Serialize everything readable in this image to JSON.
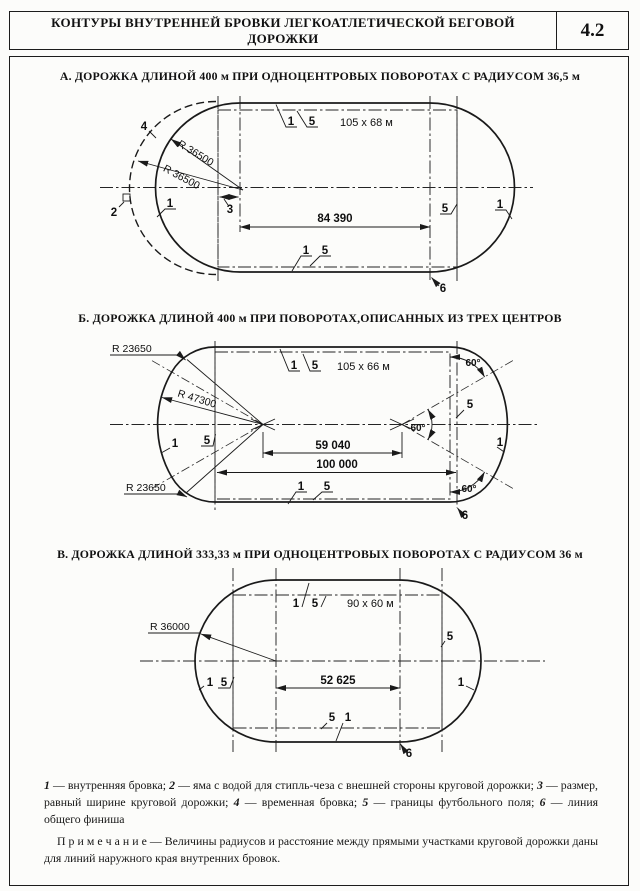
{
  "header": {
    "title": "КОНТУРЫ ВНУТРЕННЕЙ БРОВКИ ЛЕГКОАТЛЕТИЧЕСКОЙ БЕГОВОЙ ДОРОЖКИ",
    "number": "4.2"
  },
  "diagram_a": {
    "title": "А. ДОРОЖКА ДЛИНОЙ 400 м ПРИ ОДНОЦЕНТРОВЫХ ПОВОРОТАХ С РАДИУСОМ 36,5 м",
    "field_size": "105 x 68 м",
    "dim_straight": "84 390",
    "radius_curb": "R 36500",
    "radius_temp": "R 36500",
    "n1": "1",
    "n2": "2",
    "n3": "3",
    "n4": "4",
    "n5": "5",
    "n6": "6"
  },
  "diagram_b": {
    "title": "Б. ДОРОЖКА ДЛИНОЙ 400 м ПРИ ПОВОРОТАХ,ОПИСАННЫХ ИЗ ТРЕХ ЦЕНТРОВ",
    "field_size": "105 x 66 м",
    "dim_centers": "59 040",
    "dim_straight": "100 000",
    "radius_corner_top": "R 23650",
    "radius_corner_bottom": "R 23650",
    "radius_middle": "R 47300",
    "angle": "60°",
    "n1": "1",
    "n5": "5",
    "n6": "6"
  },
  "diagram_v": {
    "title": "В. ДОРОЖКА ДЛИНОЙ 333,33 м ПРИ ОДНОЦЕНТРОВЫХ ПОВОРОТАХ С РАДИУСОМ 36 м",
    "field_size": "90 x 60 м",
    "dim_straight": "52 625",
    "radius": "R 36000",
    "n1": "1",
    "n5": "5",
    "n6": "6"
  },
  "legend": {
    "items": [
      {
        "num": "1",
        "text": "— внутренняя бровка;"
      },
      {
        "num": "2",
        "text": "— яма с водой для стипль-чеза с внешней стороны круговой дорожки;"
      },
      {
        "num": "3",
        "text": "— размер, равный ширине круговой дорожки;"
      },
      {
        "num": "4",
        "text": "— временная бровка;"
      },
      {
        "num": "5",
        "text": "— границы футбольного поля;"
      },
      {
        "num": "6",
        "text": "— линия общего финиша"
      }
    ]
  },
  "note": {
    "label": "П р и м е ч а н и е",
    "text": "— Величины радиусов и расстояние между прямыми участками круговой дорожки даны для линий наружного края внутренних бровок."
  }
}
